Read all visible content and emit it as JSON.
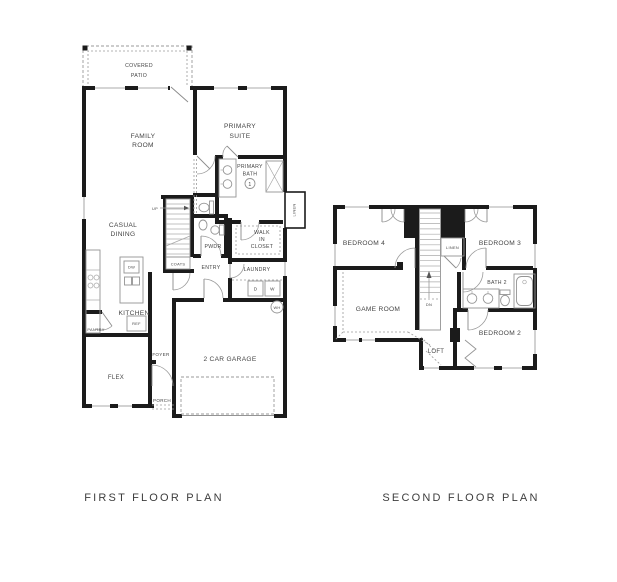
{
  "colors": {
    "wall": "#1b1b1b",
    "thin_line": "#949494",
    "dashed_line": "#9a9a9a",
    "text": "#454545",
    "background": "#ffffff"
  },
  "first_floor": {
    "title": "FIRST FLOOR PLAN",
    "labels": {
      "covered_patio": [
        "COVERED",
        "PATIO"
      ],
      "family_room": [
        "FAMILY",
        "ROOM"
      ],
      "primary_suite": [
        "PRIMARY",
        "SUITE"
      ],
      "primary_bath": [
        "PRIMARY",
        "BATH"
      ],
      "primary_bath_number": "1",
      "casual_dining": [
        "CASUAL",
        "DINING"
      ],
      "walk_in_closet": [
        "WALK",
        "IN",
        "CLOSET"
      ],
      "powder": "PWDR",
      "entry": "ENTRY",
      "laundry": "LAUNDRY",
      "dryer": "D",
      "washer": "W",
      "coats": "COATS",
      "linen": "LINEN",
      "up": "UP",
      "kitchen": "KITCHEN",
      "dishwasher": "DW",
      "refrigerator": "REF",
      "pantry": "PANTRY",
      "foyer": "FOYER",
      "flex": "FLEX",
      "porch": "PORCH",
      "garage": "2 CAR GARAGE",
      "water_heater": "WH"
    }
  },
  "second_floor": {
    "title": "SECOND FLOOR PLAN",
    "labels": {
      "bedroom_4": "BEDROOM 4",
      "bedroom_3": "BEDROOM 3",
      "bedroom_2": "BEDROOM 2",
      "game_room": "GAME ROOM",
      "bath_2": "BATH 2",
      "loft": "LOFT",
      "linen": "LINEN",
      "down": "DN"
    }
  }
}
